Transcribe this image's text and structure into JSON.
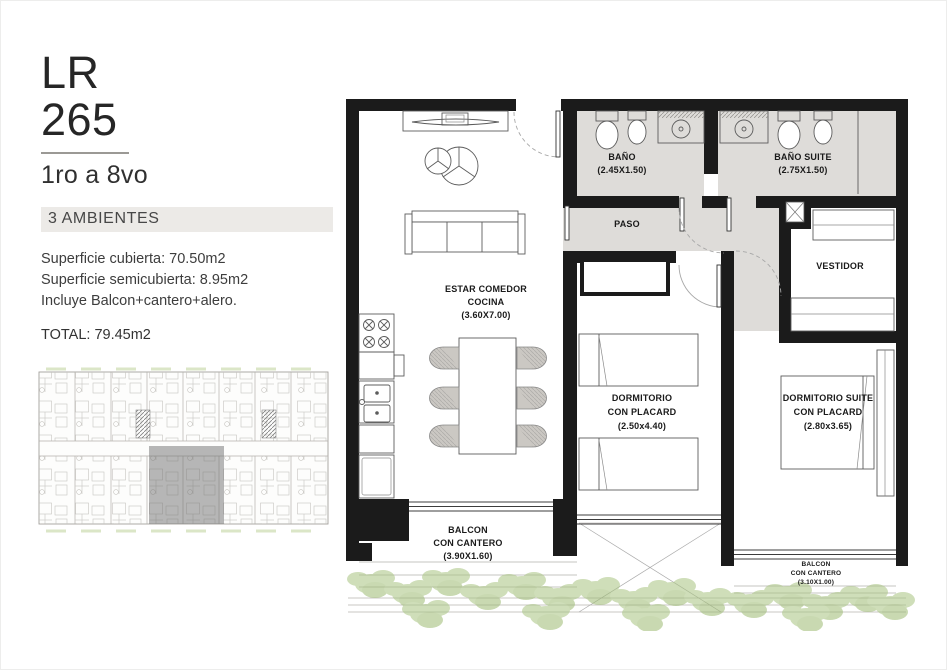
{
  "panel": {
    "title_line1": "LR",
    "title_line2": "265",
    "floors": "1ro a 8vo",
    "ambientes": "3 AMBIENTES",
    "specs": [
      "Superficie cubierta: 70.50m2",
      "Superficie semicubierta: 8.95m2",
      "Incluye Balcon+cantero+alero."
    ],
    "total": "TOTAL: 79.45m2"
  },
  "plan": {
    "living": {
      "l1": "ESTAR COMEDOR",
      "l2": "COCINA",
      "dims": "(3.60X7.00)"
    },
    "bano": {
      "name": "BAÑO",
      "dims": "(2.45X1.50)"
    },
    "bano_suite": {
      "name": "BAÑO SUITE",
      "dims": "(2.75X1.50)"
    },
    "paso": {
      "name": "PASO"
    },
    "vestidor": {
      "name": "VESTIDOR"
    },
    "dorm": {
      "l1": "DORMITORIO",
      "l2": "CON PLACARD",
      "dims": "(2.50x4.40)"
    },
    "suite": {
      "l1": "DORMITORIO SUITE",
      "l2": "CON PLACARD",
      "dims": "(2.80x3.65)"
    },
    "balcon_left": {
      "l1": "BALCON",
      "l2": "CON CANTERO",
      "dims": "(3.90X1.60)"
    },
    "balcon_right": {
      "l1": "BALCON",
      "l2": "CON CANTERO",
      "dims": "(3.10X1.00)"
    }
  },
  "colors": {
    "wall": "#1b1b1b",
    "wet_area_fill": "#dedcd9",
    "ambientes_bar": "#eceae7",
    "plants": "#a8c480",
    "keyplan_highlight": "#6f6f6f"
  }
}
